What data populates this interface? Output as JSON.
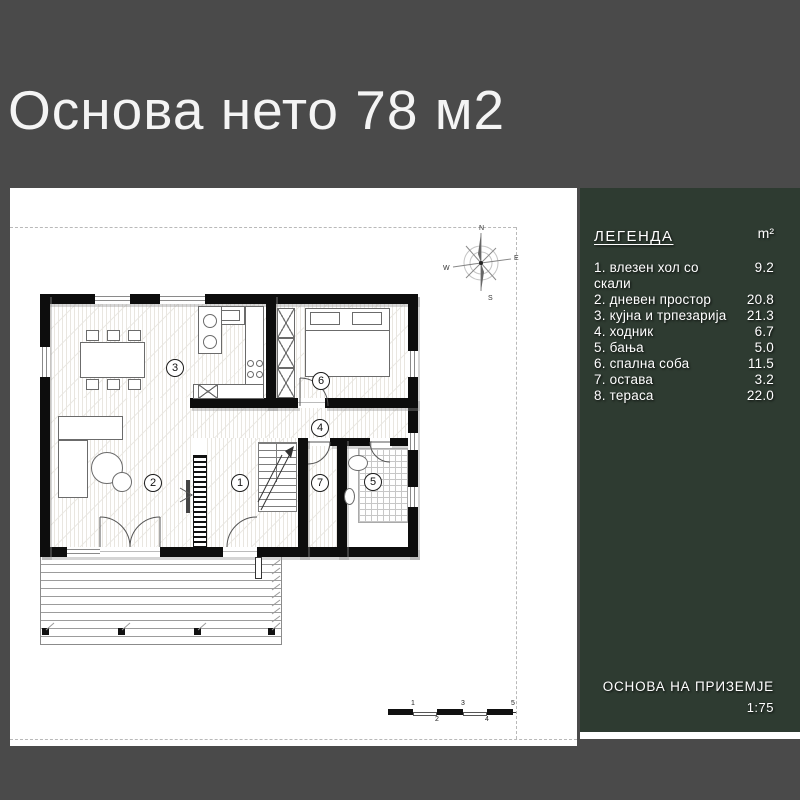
{
  "title": "Основа нето 78 м2",
  "legend": {
    "heading": "ЛЕГЕНДА",
    "unit": "m²",
    "items": [
      {
        "label": "1. влезен хол со скали",
        "area": "9.2"
      },
      {
        "label": "2. дневен простор",
        "area": "20.8"
      },
      {
        "label": "3. кујна и трпезарија",
        "area": "21.3"
      },
      {
        "label": "4. ходник",
        "area": "6.7"
      },
      {
        "label": "5. бања",
        "area": "5.0"
      },
      {
        "label": "6. спална соба",
        "area": "11.5"
      },
      {
        "label": "7. остава",
        "area": "3.2"
      },
      {
        "label": "8. тераса",
        "area": "22.0"
      }
    ]
  },
  "titleblock": {
    "drawing_name": "ОСНОВА НА ПРИЗЕМЈЕ",
    "scale": "1:75"
  },
  "compass": {
    "north": "N",
    "east": "E",
    "south": "S",
    "west": "W"
  },
  "scale_bar": {
    "ticks": [
      "1",
      "2",
      "3",
      "4",
      "5"
    ]
  },
  "plan": {
    "room_markers": [
      {
        "n": "1"
      },
      {
        "n": "2"
      },
      {
        "n": "3"
      },
      {
        "n": "4"
      },
      {
        "n": "5"
      },
      {
        "n": "6"
      },
      {
        "n": "7"
      }
    ]
  },
  "colors": {
    "page_background": "#4a4a4a",
    "legend_panel": "#2e3b31",
    "plan_paper": "#ffffff",
    "wall": "#0d0d0d"
  }
}
